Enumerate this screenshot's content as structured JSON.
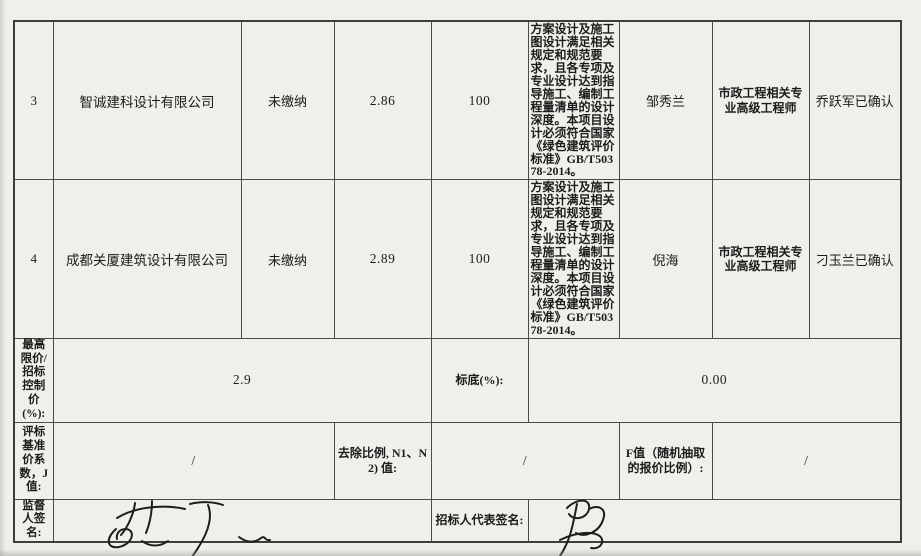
{
  "document": {
    "type_note": "scanned bid evaluation table (partial, header cut off at top)"
  },
  "table": {
    "rows": [
      {
        "no": "3",
        "company": "智诚建科设计有限公司",
        "deposit": "未缴纳",
        "price": "2.86",
        "score": "100",
        "criteria": "方案设计及施工图设计满足相关规定和规范要求，且各专项及专业设计达到指导施工、编制工程量清单的设计深度。本项目设计必须符合国家《绿色建筑评价标准》GB/T50378-2014。",
        "expert": "邹秀兰",
        "expert_title": "市政工程相关专业高级工程师",
        "confirm": "乔跃军已确认"
      },
      {
        "no": "4",
        "company": "成都关厦建筑设计有限公司",
        "deposit": "未缴纳",
        "price": "2.89",
        "score": "100",
        "criteria": "方案设计及施工图设计满足相关规定和规范要求，且各专项及专业设计达到指导施工、编制工程量清单的设计深度。本项目设计必须符合国家《绿色建筑评价标准》GB/T50378-2014。",
        "expert": "倪海",
        "expert_title": "市政工程相关专业高级工程师",
        "confirm": "刁玉兰已确认"
      }
    ],
    "limit_row": {
      "label": "最高限价/招标控制价(%):",
      "value": "2.9",
      "base_label": "标底(%):",
      "base_value": "0.00"
    },
    "coef_row": {
      "label": "评标基准价系数，J值:",
      "j_value": "/",
      "remove_label": "去除比例, N1、N2) 值:",
      "remove_value": "/",
      "f_label": "F值（随机抽取的报价比例）:",
      "f_value": "/"
    },
    "sign_row": {
      "supervisor_label": "监督人签名:",
      "bidder_label": "招标人代表签名:"
    }
  }
}
